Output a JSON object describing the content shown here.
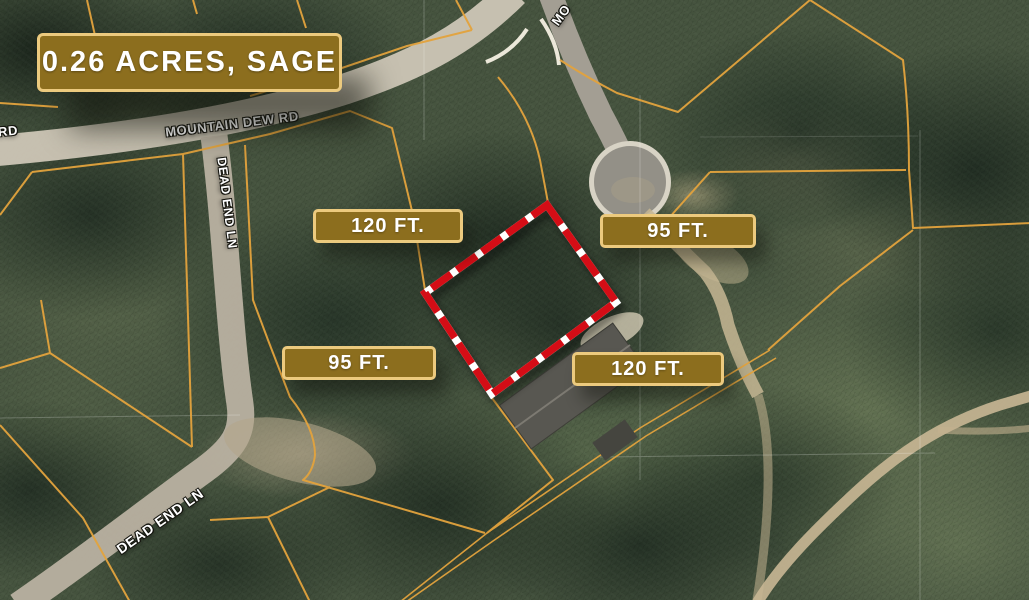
{
  "banner": {
    "text": "0.26 ACRES, SAGE"
  },
  "dimensions": [
    {
      "id": "top-width",
      "text": "120 FT."
    },
    {
      "id": "right-depth",
      "text": "95 FT."
    },
    {
      "id": "left-depth",
      "text": "95 FT."
    },
    {
      "id": "bottom-width",
      "text": "120 FT."
    }
  ],
  "roads": [
    {
      "id": "mountain-dew-rd",
      "text": "MOUNTAIN DEW RD"
    },
    {
      "id": "mountain-dew-rd-left-partial",
      "text": "RD"
    },
    {
      "id": "mountain-dew-rd-top-partial",
      "text": "MO"
    },
    {
      "id": "dead-end-ln-vertical",
      "text": "DEAD END LN"
    },
    {
      "id": "dead-end-ln-diagonal",
      "text": "DEAD END LN"
    }
  ],
  "colors": {
    "banner_bg": "#8c6e1e",
    "banner_border": "#ecca7e",
    "label_text": "#ffffff",
    "parcel_line": "#e3a33d",
    "boundary_red": "#d40e13",
    "boundary_gap": "#ffffff"
  }
}
